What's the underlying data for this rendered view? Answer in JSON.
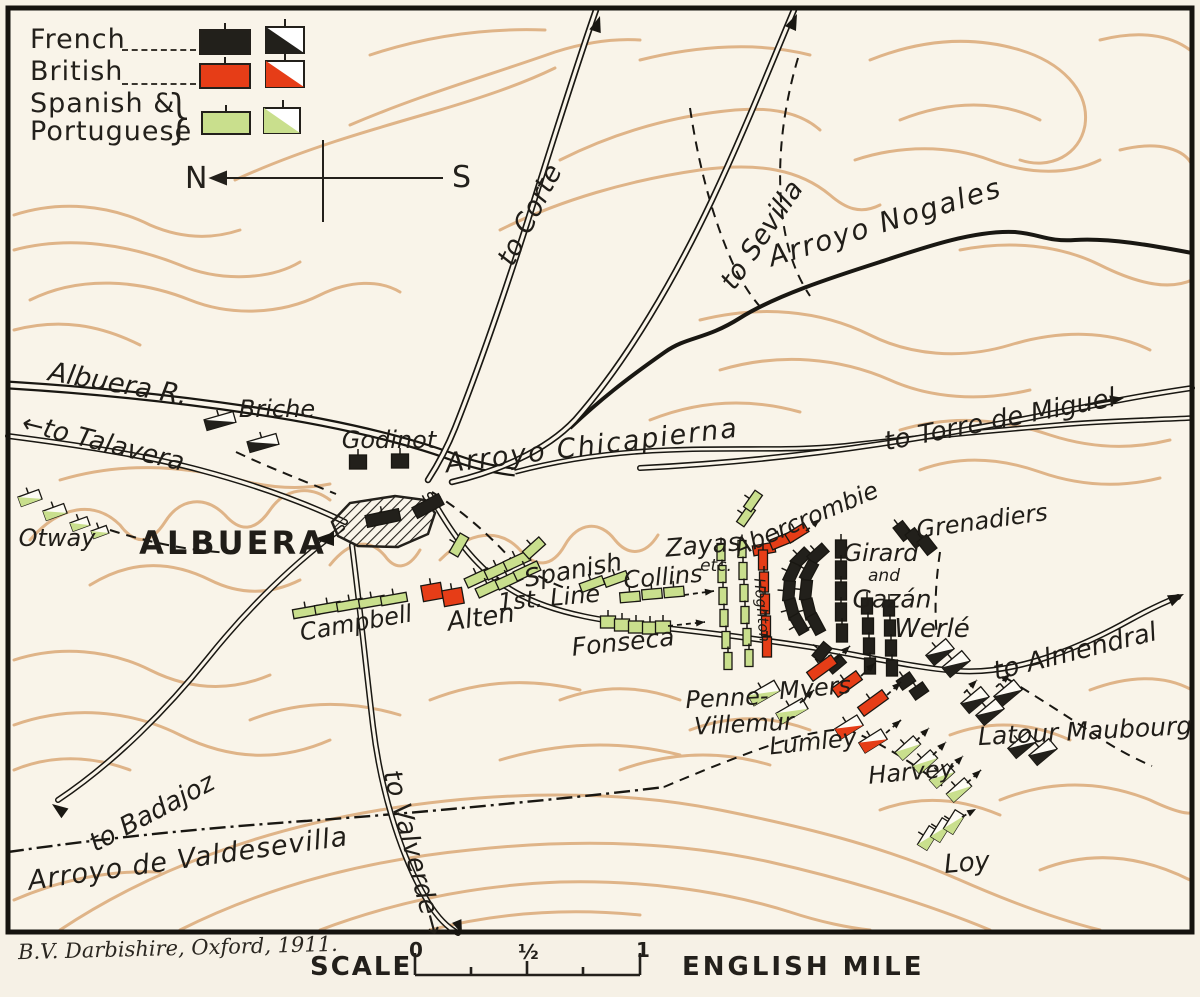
{
  "figure": {
    "attribution": "B.V. Darbishire, Oxford, 1911.",
    "scale": {
      "label": "SCALE",
      "tick_0": "0",
      "tick_half": "½",
      "tick_1": "1",
      "unit": "ENGLISH MILE"
    }
  },
  "legend": {
    "entries": [
      {
        "id": "french",
        "label": "French",
        "color": "#22201b"
      },
      {
        "id": "british",
        "label": "British",
        "color": "#e63d17"
      },
      {
        "id": "spanish_portuguese",
        "label": "Spanish &",
        "label2": "Portuguese",
        "color": "#c9df8d"
      }
    ],
    "compass": {
      "north": "N",
      "south": "S"
    }
  },
  "colors": {
    "french": "#22201b",
    "british": "#e63d17",
    "spanish": "#c9df8d",
    "paper": "#f9f4e9",
    "contour": "#d9a571",
    "ink": "#191712"
  },
  "labels": {
    "to_corte": "to Corte",
    "to_sevilla": "to Sevilla",
    "arroyo_nogales": "Arroyo  Nogales",
    "albuera_river": "Albuera R.",
    "to_talavera": "←to Talavera",
    "briche": "Briche",
    "godinot": "Godinot",
    "arroyo_chicapierna": "Arroyo   Chicapierna",
    "to_torre_de_miguel": "to Torre de Miguel",
    "otway": "Otway",
    "albuera_town": "ALBUERA",
    "spanish_line_1": "Spanish",
    "spanish_line_2": "1st. Line",
    "collins": "Collins",
    "zayas": "Zayas",
    "zayas_etc": "etc.",
    "abercrombie": "Abercrombie",
    "grenadiers": "Grenadiers",
    "girard_1": "Girard",
    "girard_2": "and",
    "girard_3": "Gazán",
    "campbell": "Campbell",
    "alten": "Alten",
    "fonseca": "Fonseca",
    "hoghton": "Hoghton",
    "werle": "Werlé",
    "to_almendral": "to Almendral",
    "penne_1": "Penne-",
    "penne_2": "Villemur",
    "myers": "Myers",
    "lumley": "Lumley",
    "latour_maubourg": "Latour Maubourg",
    "harvey": "Harvey",
    "to_badajoz": "to Badajoz",
    "arroyo_valdesevilla": "Arroyo  de  Valdesevilla",
    "to_valverde": "to Valverde→",
    "loy": "Loy"
  },
  "units": [
    [
      "f",
      "i",
      358,
      462,
      17,
      14,
      0
    ],
    [
      "f",
      "i",
      400,
      461,
      17,
      14,
      0
    ],
    [
      "f",
      "i",
      383,
      518,
      34,
      12,
      -12
    ],
    [
      "f",
      "i",
      428,
      506,
      30,
      12,
      -28
    ],
    [
      "f",
      "i",
      903,
      531,
      12,
      17,
      -38
    ],
    [
      "f",
      "i",
      915,
      538,
      12,
      17,
      -38
    ],
    [
      "f",
      "i",
      927,
      545,
      12,
      17,
      -38
    ],
    [
      "f",
      "i",
      801,
      558,
      20,
      11,
      -45
    ],
    [
      "f",
      "i",
      792,
      573,
      20,
      11,
      -65
    ],
    [
      "f",
      "i",
      789,
      591,
      20,
      11,
      -85
    ],
    [
      "f",
      "i",
      792,
      609,
      20,
      11,
      -105
    ],
    [
      "f",
      "i",
      799,
      624,
      20,
      11,
      -120
    ],
    [
      "f",
      "i",
      818,
      554,
      20,
      11,
      -42
    ],
    [
      "f",
      "i",
      809,
      571,
      20,
      11,
      -62
    ],
    [
      "f",
      "i",
      806,
      590,
      20,
      11,
      -84
    ],
    [
      "f",
      "i",
      809,
      609,
      20,
      11,
      -104
    ],
    [
      "f",
      "i",
      816,
      624,
      20,
      11,
      -118
    ],
    [
      "f",
      "i",
      841,
      549,
      11,
      18,
      0
    ],
    [
      "f",
      "i",
      841,
      570,
      11,
      18,
      0
    ],
    [
      "f",
      "i",
      841,
      591,
      11,
      18,
      0
    ],
    [
      "f",
      "i",
      841,
      612,
      11,
      18,
      0
    ],
    [
      "f",
      "i",
      842,
      633,
      11,
      18,
      0
    ],
    [
      "f",
      "i",
      822,
      652,
      18,
      11,
      -50
    ],
    [
      "f",
      "i",
      836,
      664,
      18,
      11,
      -40
    ],
    [
      "f",
      "i",
      867,
      606,
      11,
      16,
      0
    ],
    [
      "f",
      "i",
      868,
      626,
      11,
      16,
      0
    ],
    [
      "f",
      "i",
      869,
      646,
      11,
      16,
      0
    ],
    [
      "f",
      "i",
      870,
      666,
      11,
      16,
      0
    ],
    [
      "f",
      "i",
      889,
      608,
      11,
      16,
      0
    ],
    [
      "f",
      "i",
      890,
      628,
      11,
      16,
      0
    ],
    [
      "f",
      "i",
      891,
      648,
      11,
      16,
      0
    ],
    [
      "f",
      "i",
      892,
      668,
      11,
      16,
      0
    ],
    [
      "f",
      "i",
      906,
      681,
      16,
      11,
      -35
    ],
    [
      "f",
      "i",
      919,
      691,
      16,
      11,
      -35
    ],
    [
      "f",
      "c",
      220,
      421,
      30,
      11,
      -16
    ],
    [
      "f",
      "c",
      263,
      443,
      30,
      11,
      -16
    ],
    [
      "f",
      "c",
      940,
      652,
      26,
      13,
      -40
    ],
    [
      "f",
      "c",
      956,
      664,
      26,
      13,
      -40
    ],
    [
      "f",
      "c",
      975,
      700,
      26,
      13,
      -40
    ],
    [
      "f",
      "c",
      990,
      712,
      26,
      13,
      -40
    ],
    [
      "f",
      "c",
      1008,
      693,
      26,
      13,
      -40
    ],
    [
      "f",
      "c",
      1022,
      745,
      26,
      13,
      -40
    ],
    [
      "f",
      "c",
      1043,
      752,
      26,
      13,
      -40
    ],
    [
      "b",
      "i",
      432,
      592,
      20,
      16,
      -10
    ],
    [
      "b",
      "i",
      453,
      597,
      20,
      16,
      -10
    ],
    [
      "b",
      "i",
      764,
      549,
      22,
      10,
      -10
    ],
    [
      "b",
      "i",
      781,
      541,
      22,
      10,
      -22
    ],
    [
      "b",
      "i",
      797,
      533,
      22,
      10,
      -32
    ],
    [
      "b",
      "i",
      763,
      560,
      9,
      20,
      0
    ],
    [
      "b",
      "i",
      764,
      582,
      9,
      20,
      0
    ],
    [
      "b",
      "i",
      765,
      604,
      9,
      20,
      0
    ],
    [
      "b",
      "i",
      766,
      626,
      9,
      20,
      0
    ],
    [
      "b",
      "i",
      767,
      647,
      9,
      20,
      0
    ],
    [
      "b",
      "i",
      822,
      668,
      30,
      11,
      -36
    ],
    [
      "b",
      "i",
      847,
      684,
      30,
      11,
      -36
    ],
    [
      "b",
      "i",
      873,
      703,
      30,
      11,
      -36
    ],
    [
      "b",
      "c",
      849,
      727,
      26,
      12,
      -32
    ],
    [
      "b",
      "c",
      873,
      741,
      26,
      12,
      -32
    ],
    [
      "s",
      "i",
      459,
      545,
      22,
      10,
      -60
    ],
    [
      "s",
      "i",
      478,
      578,
      26,
      10,
      -25
    ],
    [
      "s",
      "i",
      498,
      570,
      26,
      10,
      -25
    ],
    [
      "s",
      "i",
      517,
      561,
      26,
      10,
      -25
    ],
    [
      "s",
      "i",
      534,
      548,
      22,
      10,
      -42
    ],
    [
      "s",
      "i",
      489,
      588,
      26,
      10,
      -25
    ],
    [
      "s",
      "i",
      509,
      580,
      26,
      10,
      -25
    ],
    [
      "s",
      "i",
      527,
      571,
      26,
      10,
      -25
    ],
    [
      "s",
      "i",
      592,
      584,
      24,
      9,
      -20
    ],
    [
      "s",
      "i",
      616,
      579,
      24,
      9,
      -20
    ],
    [
      "s",
      "i",
      306,
      612,
      26,
      9,
      -10
    ],
    [
      "s",
      "i",
      328,
      608,
      26,
      9,
      -10
    ],
    [
      "s",
      "i",
      350,
      605,
      26,
      9,
      -10
    ],
    [
      "s",
      "i",
      372,
      602,
      26,
      9,
      -10
    ],
    [
      "s",
      "i",
      394,
      599,
      26,
      9,
      -10
    ],
    [
      "s",
      "i",
      630,
      597,
      20,
      10,
      -5
    ],
    [
      "s",
      "i",
      652,
      594,
      20,
      10,
      -5
    ],
    [
      "s",
      "i",
      674,
      592,
      20,
      10,
      -5
    ],
    [
      "s",
      "i",
      608,
      622,
      15,
      12,
      0
    ],
    [
      "s",
      "i",
      622,
      625,
      15,
      12,
      0
    ],
    [
      "s",
      "i",
      636,
      627,
      15,
      12,
      0
    ],
    [
      "s",
      "i",
      650,
      628,
      15,
      12,
      0
    ],
    [
      "s",
      "i",
      663,
      627,
      15,
      12,
      0
    ],
    [
      "s",
      "i",
      721,
      552,
      8,
      17,
      0
    ],
    [
      "s",
      "i",
      722,
      574,
      8,
      17,
      0
    ],
    [
      "s",
      "i",
      723,
      596,
      8,
      17,
      0
    ],
    [
      "s",
      "i",
      724,
      618,
      8,
      17,
      0
    ],
    [
      "s",
      "i",
      726,
      640,
      8,
      17,
      0
    ],
    [
      "s",
      "i",
      728,
      661,
      8,
      17,
      0
    ],
    [
      "s",
      "i",
      742,
      549,
      8,
      17,
      0
    ],
    [
      "s",
      "i",
      743,
      571,
      8,
      17,
      0
    ],
    [
      "s",
      "i",
      744,
      593,
      8,
      17,
      0
    ],
    [
      "s",
      "i",
      745,
      615,
      8,
      17,
      0
    ],
    [
      "s",
      "i",
      747,
      637,
      8,
      17,
      0
    ],
    [
      "s",
      "i",
      749,
      658,
      8,
      17,
      0
    ],
    [
      "s",
      "i",
      746,
      516,
      20,
      9,
      -55
    ],
    [
      "s",
      "i",
      753,
      501,
      20,
      9,
      -55
    ],
    [
      "s",
      "c",
      30,
      498,
      22,
      10,
      -20
    ],
    [
      "s",
      "c",
      55,
      512,
      22,
      10,
      -20
    ],
    [
      "s",
      "c",
      80,
      524,
      18,
      9,
      -20
    ],
    [
      "s",
      "c",
      100,
      532,
      16,
      8,
      -20
    ],
    [
      "s",
      "c",
      764,
      693,
      30,
      12,
      -30
    ],
    [
      "s",
      "c",
      792,
      711,
      30,
      12,
      -30
    ],
    [
      "s",
      "c",
      908,
      748,
      24,
      11,
      -42
    ],
    [
      "s",
      "c",
      925,
      762,
      24,
      11,
      -42
    ],
    [
      "s",
      "c",
      942,
      776,
      24,
      11,
      -42
    ],
    [
      "s",
      "c",
      959,
      790,
      24,
      11,
      -42
    ],
    [
      "s",
      "c",
      928,
      838,
      22,
      11,
      -58
    ],
    [
      "s",
      "c",
      941,
      830,
      22,
      11,
      -58
    ],
    [
      "s",
      "c",
      954,
      822,
      22,
      11,
      -58
    ]
  ],
  "movement_arrows": [
    [
      684,
      595,
      714,
      591
    ],
    [
      668,
      626,
      705,
      622
    ],
    [
      806,
      531,
      820,
      519
    ],
    [
      836,
      659,
      850,
      646
    ],
    [
      861,
      676,
      875,
      663
    ],
    [
      887,
      695,
      901,
      682
    ],
    [
      886,
      733,
      901,
      720
    ],
    [
      800,
      703,
      814,
      690
    ],
    [
      916,
      741,
      929,
      728
    ],
    [
      933,
      755,
      946,
      742
    ],
    [
      950,
      769,
      963,
      756
    ],
    [
      967,
      783,
      981,
      770
    ],
    [
      996,
      687,
      1010,
      674
    ],
    [
      964,
      693,
      977,
      680
    ],
    [
      962,
      817,
      976,
      809
    ]
  ]
}
